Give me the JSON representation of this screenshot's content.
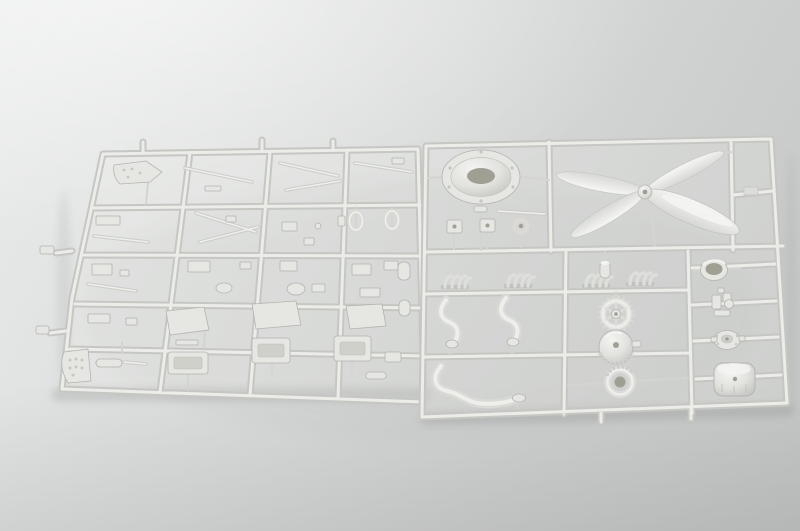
{
  "photo": {
    "subject": "Plastic model aircraft kit sprues",
    "description": "Two light-grey injection-moulded sprues holding unassembled model aircraft parts, photographed on a neutral grey studio background",
    "sprue_count": 2
  },
  "palette": {
    "bg_top": "#eaeceb",
    "bg_mid": "#d8dad9",
    "bg_bottom": "#c3c5c4",
    "run_dark": "#c6c6c3",
    "run_light": "#ecece9",
    "plastic_base": "#e6e6e3",
    "plastic_bright": "#f4f4f2",
    "plastic_outline": "#b3b3b0",
    "recess": "#a09f94",
    "shadow": "#8e908f"
  },
  "sprues": {
    "left": {
      "label": "left sprue with flat airframe and cockpit parts",
      "grid": {
        "columns": 4,
        "rows": 5
      }
    },
    "right": {
      "label": "right sprue with engine and propeller parts",
      "notable_parts": [
        "engine cowling ring",
        "four-blade propeller",
        "open cowl ring",
        "exhaust manifold stubs",
        "S-shaped exhaust pipes",
        "reduction gear ring",
        "finned crankcase drum",
        "clamp ring",
        "carburettor assembly",
        "round access cap",
        "engine drum"
      ]
    }
  }
}
